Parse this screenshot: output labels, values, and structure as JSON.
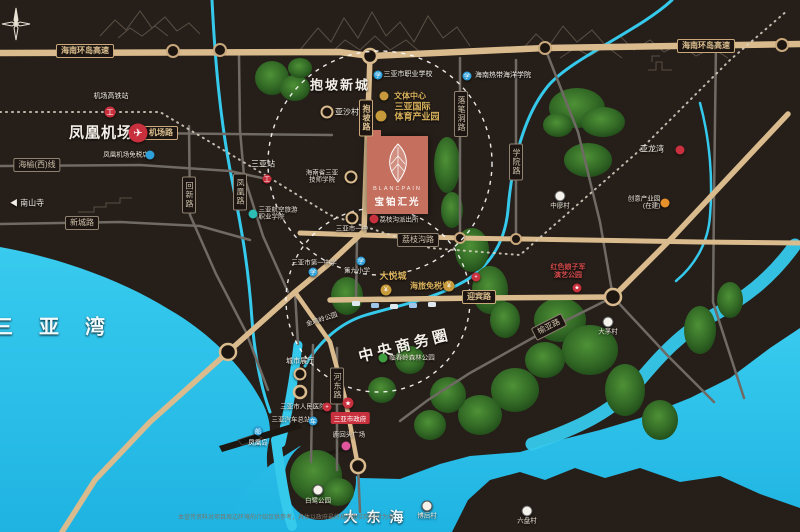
{
  "areas": {
    "baopo": "抱坡新城",
    "cbd": "中央商务圈",
    "sanya_bay": "三亚湾",
    "dadonghai": "大东海"
  },
  "project": {
    "brand": "BLANCPAIN",
    "name": "宝铂汇光"
  },
  "roads": {
    "expwy_left": "海南环岛高速",
    "expwy_right": "海南环岛高速",
    "jichang_rd": "机场路",
    "haiyu_west": "海榆(西)线",
    "xincheng_rd": "新城路",
    "huixin_rd": "回新路",
    "fenghuang_rd": "凤凰路",
    "baopo_rd": "抱坡路",
    "luobidong_rd": "落笔洞路",
    "xueyuan_rd": "学院路",
    "lizhigou_rd": "荔枝沟路",
    "yingbin_rd": "迎宾路",
    "yuya_rd": "榆亚路",
    "hedong_rd": "河东路"
  },
  "transport": {
    "airport": "凤凰机场",
    "airport_hsr": "机场高铁站",
    "sanya_station": "三亚站",
    "bus_station": "三亚汽车总站",
    "phoenix_island": "凤凰岛",
    "airport_dutyfree": "凤凰机场免税店"
  },
  "pois": {
    "nanshan": "南山寺",
    "yasha": "亚沙村",
    "wenti_center": "文体中心",
    "sports_park_l1": "三亚国际",
    "sports_park_l2": "体育产业园",
    "jishi_college_l1": "海南省三亚",
    "jishi_college_l2": "技师学院",
    "vocational_school": "三亚市职业学校",
    "tropical_ocean_univ": "海南热带海洋学院",
    "no1_middle_school": "三亚市第一中学",
    "no9_primary": "第九小学",
    "aviation_college_l1": "三亚航空旅游",
    "aviation_college_l2": "职业学院",
    "yizhong": "三亚市一中",
    "lizhigou_police": "荔枝沟派出所",
    "joy_city": "大悦城",
    "duty_free": "海旅免税城",
    "peoples_hospital": "三亚市人民医院",
    "city_gov": "三亚市政府",
    "city_hall": "城市展厅",
    "luhuitou": "鹿回头广场",
    "linchun_park": "临春岭森林公园",
    "jinjiling_park": "金鸡岭公园",
    "egret_park": "白鹭公园",
    "yalong_bay": "亚龙湾",
    "red_show_l1": "红色娘子军",
    "red_show_l2": "演艺公园",
    "tech_park_l1": "创意产业园",
    "tech_park_l2": "(在建)",
    "zhongliao": "中廖村",
    "damao": "大茅村",
    "bohou": "博后村",
    "liupan": "六盘村"
  },
  "icons": {
    "airplane": "✈",
    "train": "工",
    "bus": "车",
    "hospital": "+",
    "star": "★",
    "shop": "¥",
    "school": "学",
    "museum": "展",
    "arrow_left": "◀",
    "boat": "船",
    "tree": "木"
  },
  "footer": {
    "disclaimer": "本宣传资料对项目周边环境的介绍仅供参考，具体以政府最终规划及实际交付为准"
  }
}
